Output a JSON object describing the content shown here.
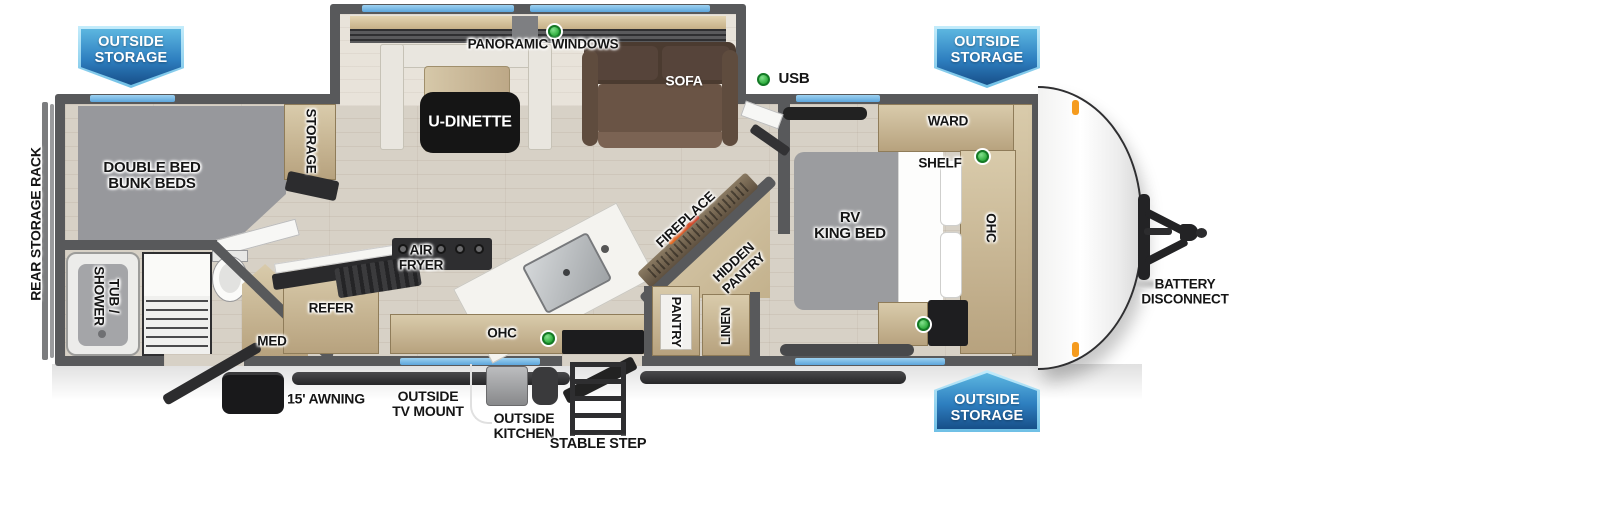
{
  "badges": {
    "top_left": "OUTSIDE\nSTORAGE",
    "top_right": "OUTSIDE\nSTORAGE",
    "bottom_right": "OUTSIDE\nSTORAGE"
  },
  "legend": {
    "usb": "USB"
  },
  "exterior_labels": {
    "rear_storage_rack": "REAR STORAGE RACK",
    "awning": "15' AWNING",
    "outside_tv_mount": "OUTSIDE\nTV MOUNT",
    "outside_kitchen": "OUTSIDE\nKITCHEN",
    "stable_step": "STABLE STEP",
    "battery_disconnect": "BATTERY\nDISCONNECT"
  },
  "interior_labels": {
    "panoramic_windows": "PANORAMIC WINDOWS",
    "u_dinette": "U-DINETTE",
    "sofa": "SOFA",
    "ward": "WARD",
    "shelf": "SHELF",
    "rv_king_bed": "RV\nKING BED",
    "ohc_bedroom": "OHC",
    "fireplace": "FIREPLACE",
    "hidden_pantry": "HIDDEN\nPANTRY",
    "pantry": "PANTRY",
    "linen": "LINEN",
    "double_bed_bunk_beds": "DOUBLE BED\nBUNK BEDS",
    "storage": "STORAGE",
    "tub_shower": "TUB /\nSHOWER",
    "med": "MED",
    "refer": "REFER",
    "air_fryer": "AIR\nFRYER",
    "ohc_kitchen": "OHC"
  },
  "colors": {
    "wall_gray": "#58595b",
    "window_blue": "#74b6e4",
    "usb_green": "#2fae3e",
    "badge_blue_top": "#5cb6e0",
    "badge_blue_bottom": "#174f89",
    "floor_tan": "#d7d1c6",
    "wood": "#c7b08a",
    "bed_gray": "#9b9c9f",
    "sofa_brown": "#6a5445",
    "marker_orange": "#f59b1e"
  }
}
